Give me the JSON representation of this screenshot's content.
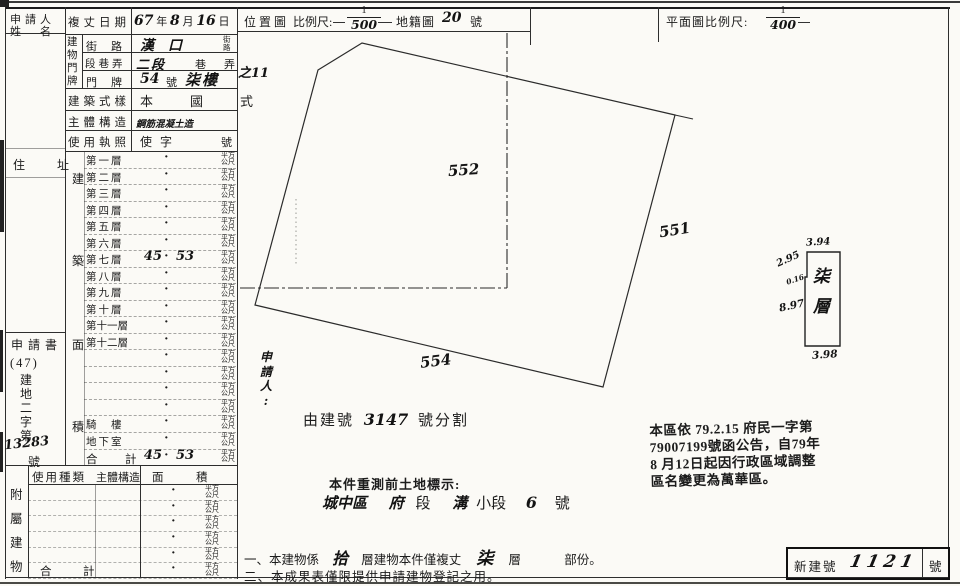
{
  "sheet": {
    "dot": "·",
    "unit_lines": [
      "平方",
      "公尺"
    ],
    "applicant_label1": "申請人",
    "applicant_label2": "姓　名",
    "address_label": "住　址",
    "survey": {
      "label": "複丈日期",
      "y": "67",
      "y_unit": "年",
      "m": "8",
      "m_unit": "月",
      "d": "16",
      "d_unit": "日"
    },
    "doorplate": {
      "vchars": [
        "建",
        "物",
        "門",
        "牌"
      ],
      "street_label": "街路",
      "street_value": "漢口",
      "street_suffix1": "街",
      "street_suffix2": "路",
      "section_label": "段巷弄",
      "section_value": "二段",
      "section_mid": "巷",
      "section_end": "弄",
      "number_label": "門牌",
      "number_value": "54",
      "number_unit": "號",
      "floor_value": "柒樓",
      "extra": "之11"
    },
    "style_row": {
      "label": "建築式樣",
      "value": "本　國　式"
    },
    "structure_row": {
      "label": "主體構造",
      "value": "鋼筋混凝土造"
    },
    "license_row": {
      "label": "使用執照",
      "value": "使字",
      "unit": "號"
    },
    "application": {
      "label": "申請書",
      "paren": "(47)",
      "vchars": [
        "建",
        "地",
        "二",
        "字",
        "第"
      ],
      "number": "13283",
      "suffix": "號"
    },
    "area_vchars": [
      "建",
      "築",
      "面",
      "積"
    ],
    "floors": [
      {
        "label": "第一層"
      },
      {
        "label": "第二層"
      },
      {
        "label": "第三層"
      },
      {
        "label": "第四層"
      },
      {
        "label": "第五層"
      },
      {
        "label": "第六層",
        "v1": "",
        "v2": ""
      },
      {
        "label": "第七層",
        "v1": "45",
        "v2": "53"
      },
      {
        "label": "第八層"
      },
      {
        "label": "第九層"
      },
      {
        "label": "第十層"
      },
      {
        "label": "第十一層"
      },
      {
        "label": "第十二層"
      },
      {
        "label": ""
      },
      {
        "label": ""
      },
      {
        "label": ""
      },
      {
        "label": ""
      },
      {
        "label": "騎　樓"
      },
      {
        "label": "地下室"
      },
      {
        "label": "合　計",
        "v1": "45",
        "v2": "53",
        "strong": true
      }
    ],
    "annex": {
      "vchars": [
        "附",
        "屬",
        "建",
        "物"
      ],
      "header1": "使用種類",
      "header2": "主體構造",
      "header3": "面",
      "header4": "積",
      "rows": [
        {
          "label": ""
        },
        {
          "label": ""
        },
        {
          "label": ""
        },
        {
          "label": ""
        },
        {
          "label": ""
        },
        {
          "label": "合　計",
          "strong": true
        }
      ]
    }
  },
  "map": {
    "header": {
      "title": "位置圖",
      "scale_label": "比例尺:",
      "scale_num": "1",
      "scale_den": "500",
      "cadastral": "地籍圖",
      "sheet_no": "20",
      "unit": "號"
    },
    "parcel_552": "552",
    "parcel_551": "551",
    "parcel_554": "554",
    "applicant_chars": [
      "申",
      "請",
      "人",
      ":"
    ],
    "split_prefix": "由建號",
    "split_no": "3147",
    "split_suffix": "號分割",
    "pre_title": "本件重測前土地標示:",
    "pre_value": {
      "district": "城中區",
      "sec": "府",
      "sec_unit": "段",
      "subsec": "溝",
      "subsec_unit": "小段",
      "lot": "6",
      "lot_unit": "號"
    }
  },
  "plan": {
    "header_label": "平面圖比例尺:",
    "scale_num": "1",
    "scale_den": "400",
    "floor_chars": [
      "柒",
      "層"
    ],
    "dims": {
      "top": "3.94",
      "upper_left": "2.95",
      "notch": "0.16",
      "left": "8.97",
      "bottom": "3.98"
    }
  },
  "stamp": {
    "lines": [
      "本區依 79.2.15 府民一字第",
      "79007199號函公告，自79年",
      "8 月12日起因行政區域調整",
      "區名變更為萬華區。"
    ]
  },
  "notes": {
    "n1_a": "一、本建物係",
    "n1_b": "拾",
    "n1_c": "層建物本件僅複丈",
    "n1_d": "柒",
    "n1_e": "層",
    "n1_f": "部份。",
    "n2": "二、本成果表僅限提供申請建物登記之用。"
  },
  "newno": {
    "label": "新建號",
    "value": "1121",
    "unit": "號"
  }
}
